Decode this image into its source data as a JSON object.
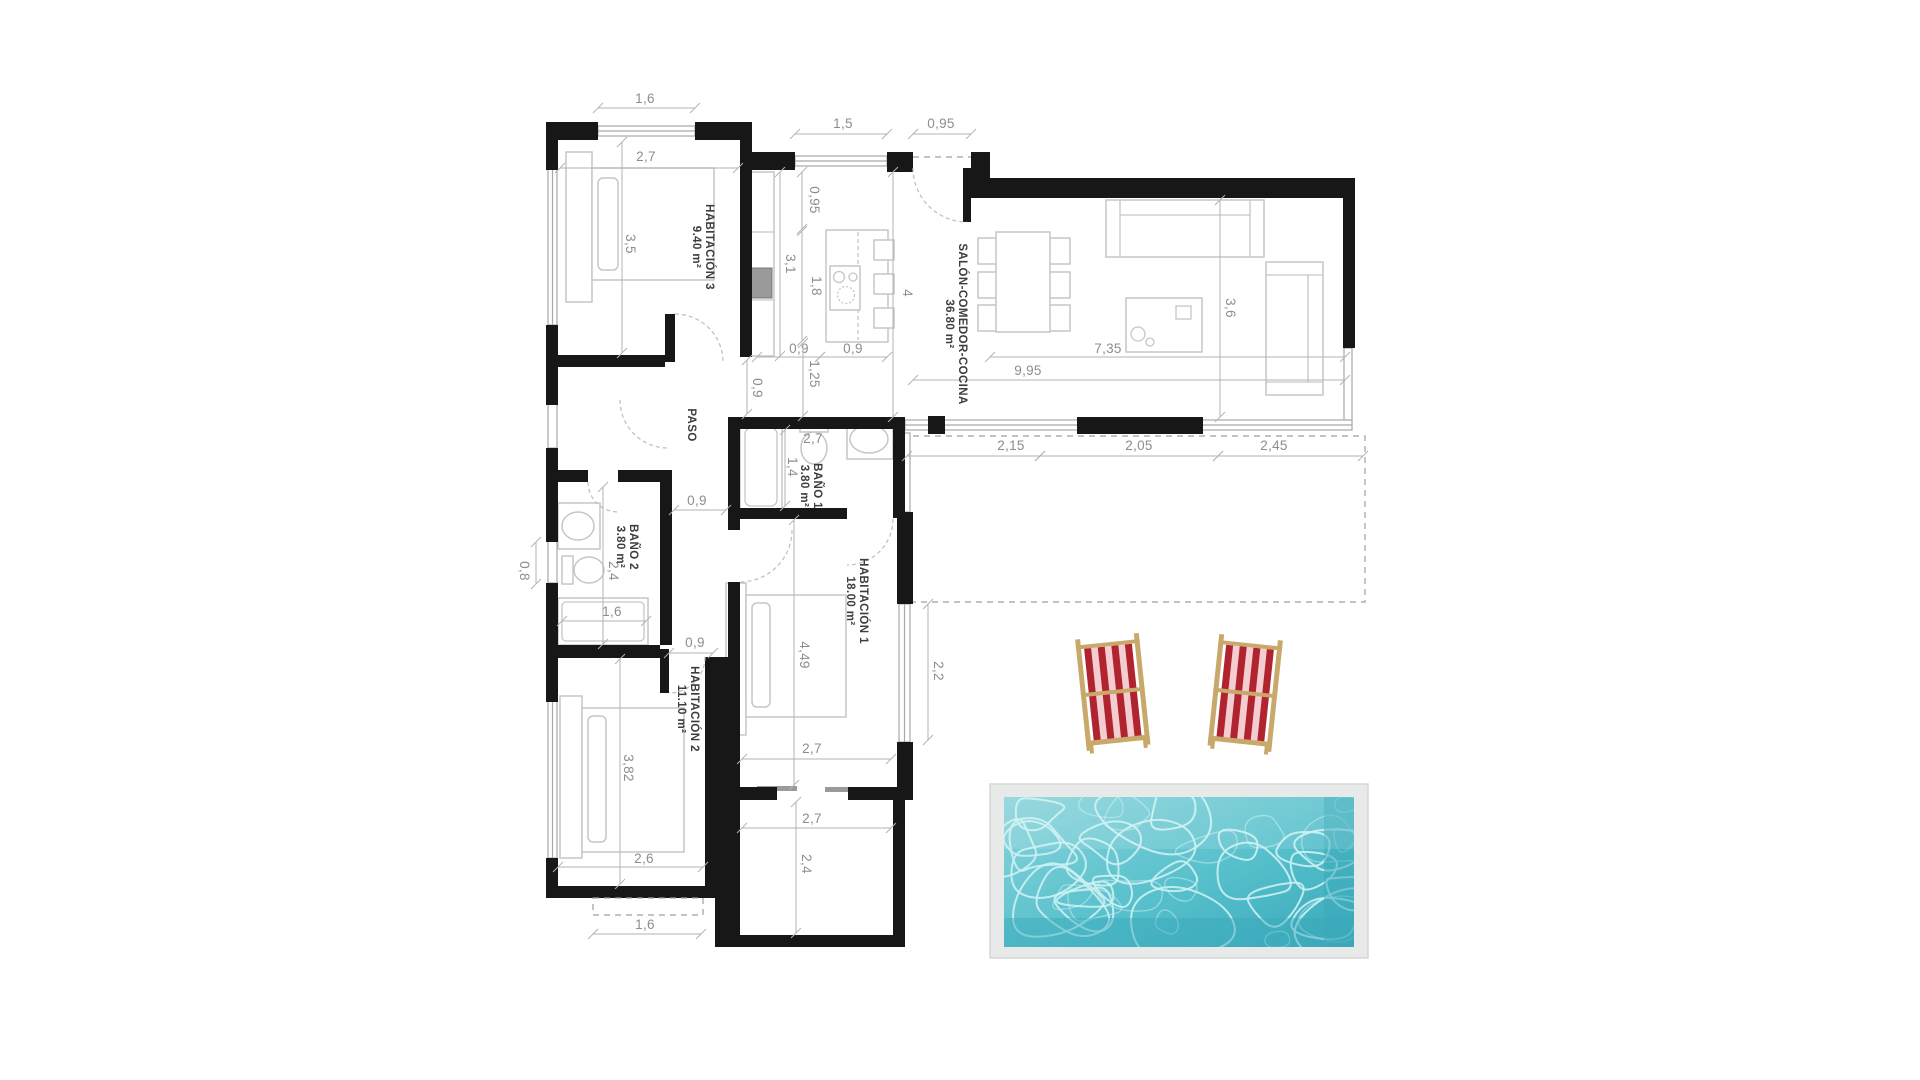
{
  "plan": {
    "rooms": [
      {
        "name": "HABITACIÓN 3",
        "area": "9.40 m²",
        "x": 704,
        "y": 247
      },
      {
        "name": "SALÓN-COMEDOR-COCINA",
        "area": "36.80 m²",
        "x": 957,
        "y": 324
      },
      {
        "name": "PASO",
        "area": "",
        "x": 692,
        "y": 425
      },
      {
        "name": "BAÑO 1",
        "area": "3.80 m²",
        "x": 812,
        "y": 486
      },
      {
        "name": "BAÑO 2",
        "area": "3.80 m²",
        "x": 628,
        "y": 547
      },
      {
        "name": "HABITACIÓN 1",
        "area": "18.00 m²",
        "x": 858,
        "y": 601
      },
      {
        "name": "HABITACIÓN 2",
        "area": "11.10 m²",
        "x": 689,
        "y": 709
      }
    ],
    "dimensions": [
      {
        "v": "1,6",
        "x": 645,
        "y": 99,
        "r": 0,
        "line": [
          598,
          108,
          695,
          108
        ]
      },
      {
        "v": "2,7",
        "x": 646,
        "y": 157,
        "r": 0,
        "line": [
          560,
          168,
          738,
          168
        ]
      },
      {
        "v": "3,5",
        "x": 630,
        "y": 244,
        "r": 90,
        "line": [
          622,
          142,
          622,
          353
        ]
      },
      {
        "v": "1,5",
        "x": 843,
        "y": 124,
        "r": 0,
        "line": [
          795,
          134,
          887,
          134
        ]
      },
      {
        "v": "0,95",
        "x": 941,
        "y": 124,
        "r": 0,
        "line": [
          913,
          134,
          971,
          134
        ]
      },
      {
        "v": "0,95",
        "x": 814,
        "y": 200,
        "r": 90,
        "line": [
          802,
          172,
          802,
          229
        ]
      },
      {
        "v": "3,1",
        "x": 790,
        "y": 264,
        "r": 90,
        "line": [
          780,
          172,
          780,
          356
        ]
      },
      {
        "v": "1,8",
        "x": 816,
        "y": 286,
        "r": 90,
        "line": [
          802,
          231,
          802,
          341
        ]
      },
      {
        "v": "4",
        "x": 907,
        "y": 293,
        "r": 90,
        "line": [
          893,
          172,
          893,
          417
        ]
      },
      {
        "v": "0,9",
        "x": 799,
        "y": 349,
        "r": 0,
        "line": [
          757,
          357,
          820,
          357
        ]
      },
      {
        "v": "0,9",
        "x": 853,
        "y": 349,
        "r": 0,
        "line": [
          820,
          357,
          887,
          357
        ]
      },
      {
        "v": "1,25",
        "x": 814,
        "y": 374,
        "r": 90,
        "line": [
          803,
          343,
          803,
          416
        ]
      },
      {
        "v": "0,9",
        "x": 757,
        "y": 388,
        "r": 90,
        "line": [
          747,
          360,
          747,
          414
        ]
      },
      {
        "v": "9,95",
        "x": 1028,
        "y": 371,
        "r": 0,
        "line": [
          913,
          380,
          1345,
          380
        ]
      },
      {
        "v": "7,35",
        "x": 1108,
        "y": 349,
        "r": 0,
        "line": [
          990,
          357,
          1345,
          357
        ]
      },
      {
        "v": "3,6",
        "x": 1230,
        "y": 308,
        "r": 90,
        "line": [
          1220,
          200,
          1220,
          417
        ]
      },
      {
        "v": "2,15",
        "x": 1011,
        "y": 446,
        "r": 0,
        "line": [
          907,
          456,
          1040,
          456
        ]
      },
      {
        "v": "2,05",
        "x": 1139,
        "y": 446,
        "r": 0,
        "line": [
          1040,
          456,
          1218,
          456
        ]
      },
      {
        "v": "2,45",
        "x": 1274,
        "y": 446,
        "r": 0,
        "line": [
          1218,
          456,
          1363,
          456
        ]
      },
      {
        "v": "2,7",
        "x": 813,
        "y": 439,
        "r": 0,
        "line": null
      },
      {
        "v": "1,4",
        "x": 792,
        "y": 467,
        "r": 90,
        "line": [
          785,
          430,
          785,
          506
        ]
      },
      {
        "v": "0,9",
        "x": 697,
        "y": 501,
        "r": 0,
        "line": [
          674,
          510,
          726,
          510
        ]
      },
      {
        "v": "0,8",
        "x": 524,
        "y": 571,
        "r": 90,
        "line": [
          536,
          542,
          536,
          584
        ]
      },
      {
        "v": "2,4",
        "x": 613,
        "y": 571,
        "r": 90,
        "line": [
          603,
          487,
          603,
          644
        ]
      },
      {
        "v": "1,6",
        "x": 612,
        "y": 612,
        "r": 0,
        "line": [
          562,
          621,
          646,
          621
        ]
      },
      {
        "v": "0,9",
        "x": 695,
        "y": 643,
        "r": 0,
        "line": [
          669,
          653,
          713,
          653
        ]
      },
      {
        "v": "4,49",
        "x": 804,
        "y": 655,
        "r": 90,
        "line": [
          794,
          520,
          794,
          785
        ]
      },
      {
        "v": "2,2",
        "x": 938,
        "y": 671,
        "r": 90,
        "line": [
          928,
          604,
          928,
          740
        ]
      },
      {
        "v": "2,7",
        "x": 812,
        "y": 749,
        "r": 0,
        "line": [
          742,
          759,
          891,
          759
        ]
      },
      {
        "v": "2,7",
        "x": 812,
        "y": 819,
        "r": 0,
        "line": [
          742,
          828,
          891,
          828
        ]
      },
      {
        "v": "2,4",
        "x": 806,
        "y": 864,
        "r": 90,
        "line": [
          796,
          802,
          796,
          933
        ]
      },
      {
        "v": "3,82",
        "x": 628,
        "y": 768,
        "r": 90,
        "line": [
          620,
          659,
          620,
          884
        ]
      },
      {
        "v": "2,6",
        "x": 644,
        "y": 859,
        "r": 0,
        "line": [
          558,
          867,
          703,
          867
        ]
      },
      {
        "v": "1,6",
        "x": 645,
        "y": 925,
        "r": 0,
        "line": [
          593,
          934,
          701,
          934
        ]
      }
    ]
  },
  "colors": {
    "wall": "#171717",
    "thin_line": "#a8a8a8",
    "furniture": "#c6c6c6",
    "dim_text": "#8d8d8d",
    "room_text": "#3d3d3d",
    "pool_deck": "#e8eae9",
    "pool_water_light": "#8ad4da",
    "pool_water": "#57c0cc",
    "pool_water_dark": "#3aa9ba",
    "pool_ripple": "#cbf1f3",
    "chair_red": "#b02430",
    "chair_pink": "#f4cdd0",
    "chair_wood": "#c9a96b"
  }
}
